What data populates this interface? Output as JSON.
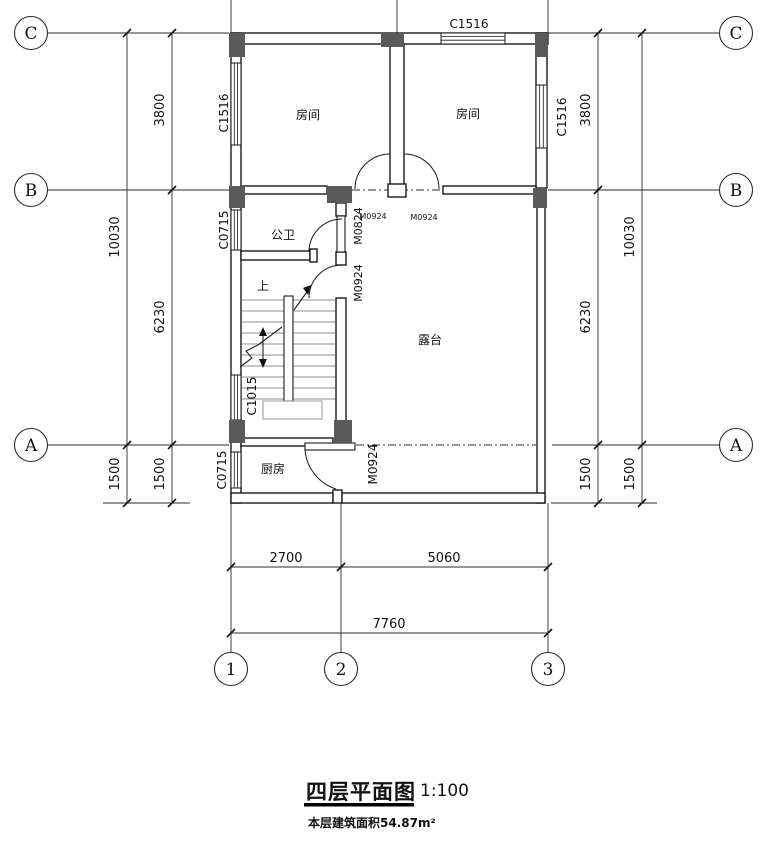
{
  "title": {
    "text": "四层平面图",
    "scale": "1:100",
    "area_note": "本层建筑面积54.87m²"
  },
  "rooms": {
    "room_left": "房间",
    "room_right": "房间",
    "bathroom": "公卫",
    "terrace": "露台",
    "kitchen": "厨房",
    "stair_up": "上"
  },
  "grid": {
    "row_labels": [
      "C",
      "B",
      "A"
    ],
    "col_labels": [
      "1",
      "2",
      "3"
    ]
  },
  "dimensions": {
    "left_outer": [
      "10030",
      "1500"
    ],
    "left_inner": [
      "3800",
      "6230",
      "1500"
    ],
    "right_inner": [
      "3800",
      "6230",
      "1500"
    ],
    "right_outer": [
      "10030",
      "1500"
    ],
    "bottom_row1": [
      "2700",
      "5060"
    ],
    "bottom_row2": [
      "7760"
    ]
  },
  "openings": {
    "top_window": "C1516",
    "left_room_window": "C1516",
    "right_room_window": "C1516",
    "bathroom_window": "C0715",
    "stair_window": "C1015",
    "kitchen_window": "C0715",
    "room_left_door_label": "M0924",
    "room_right_door_label": "M0924",
    "bathroom_door_label": "M0824",
    "hall_door_label": "M0924",
    "kitchen_door_label": "M0924"
  },
  "colors": {
    "line": "#1a1a1a",
    "column": "#5a5a5a",
    "tread": "#8f8f8f",
    "axis": "#2b2b2b"
  }
}
